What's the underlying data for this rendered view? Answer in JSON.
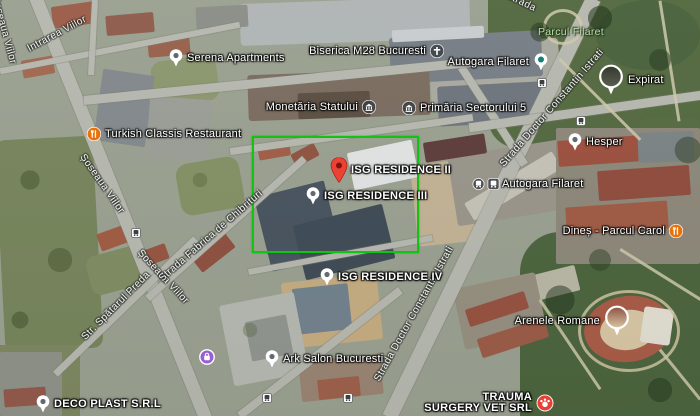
{
  "map": {
    "view": "satellite",
    "colors": {
      "selection_green": "#0fc512",
      "pin_red": "#EA4335",
      "restaurant_orange": "#E8710A",
      "shop_purple": "#9A5FD0",
      "transit_teal": "#12827A",
      "park_label_green": "#B6E0A2",
      "label_white": "#FFFFFF"
    },
    "selection_box": {
      "x": 252,
      "y": 136,
      "width": 167,
      "height": 117
    },
    "pois": [
      {
        "slug": "serena-apartments",
        "label": "Serena Apartments",
        "icon": "generic-poi-icon",
        "x": 176,
        "y": 58,
        "side": "right",
        "weight": "normal"
      },
      {
        "slug": "turkish-classis-restaurant",
        "label": "Turkish Classis Restaurant",
        "icon": "restaurant-icon",
        "x": 94,
        "y": 134,
        "side": "right",
        "weight": "normal"
      },
      {
        "slug": "biserica-m28-bucuresti",
        "label": "Biserica M28 Bucuresti",
        "icon": "church-icon",
        "x": 437,
        "y": 51,
        "side": "left",
        "weight": "normal"
      },
      {
        "slug": "monetaria-statului",
        "label": "Monetăria Statului",
        "icon": "government-icon",
        "x": 369,
        "y": 107,
        "side": "left",
        "weight": "normal"
      },
      {
        "slug": "primaria-sectorului-5",
        "label": "Primăria Sectorului 5",
        "icon": "government-icon",
        "x": 409,
        "y": 108,
        "side": "right",
        "weight": "normal"
      },
      {
        "slug": "autogara-filaret-pin",
        "label": "Autogara Filaret",
        "icon": "transit-pin-icon",
        "x": 541,
        "y": 62,
        "side": "left",
        "weight": "normal"
      },
      {
        "slug": "expirat",
        "label": "Expirat",
        "icon": "photo-pin-icon",
        "thumb": "dark",
        "x": 611,
        "y": 80,
        "side": "right",
        "weight": "normal"
      },
      {
        "slug": "hesper",
        "label": "Hesper",
        "icon": "generic-poi-icon",
        "x": 575,
        "y": 142,
        "side": "right",
        "weight": "normal"
      },
      {
        "slug": "autogara-filaret",
        "label": "Autogara Filaret",
        "icon": "bus-badges-icon",
        "x": 486,
        "y": 184,
        "side": "right",
        "weight": "normal"
      },
      {
        "slug": "isg-residence-ii",
        "label": "ISG RESIDENCE II",
        "icon": "red-pin-icon",
        "x": 339,
        "y": 170,
        "side": "right",
        "weight": "bold"
      },
      {
        "slug": "isg-residence-iii",
        "label": "ISG RESIDENCE III",
        "icon": "generic-poi-icon",
        "x": 313,
        "y": 196,
        "side": "right",
        "weight": "bold"
      },
      {
        "slug": "isg-residence-iv",
        "label": "ISG RESIDENCE IV",
        "icon": "generic-poi-icon",
        "x": 327,
        "y": 277,
        "side": "right",
        "weight": "bold"
      },
      {
        "slug": "ark-salon-bucuresti",
        "label": "Ark Salon Bucuresti",
        "icon": "generic-poi-icon",
        "x": 272,
        "y": 359,
        "side": "right",
        "weight": "normal"
      },
      {
        "slug": "deco-plast-srl",
        "label": "DECO PLAST S.R.L",
        "icon": "generic-poi-icon",
        "x": 43,
        "y": 404,
        "side": "right",
        "weight": "bold"
      },
      {
        "slug": "dines-parcul-carol",
        "label": "Dineș - Parcul Carol",
        "icon": "restaurant-icon",
        "x": 676,
        "y": 231,
        "side": "left",
        "weight": "normal"
      },
      {
        "slug": "arenele-romane",
        "label": "Arenele Romane",
        "icon": "photo-pin-icon",
        "thumb": "warm",
        "x": 617,
        "y": 321,
        "side": "left",
        "weight": "normal"
      },
      {
        "slug": "trauma-surgery-vet-srl",
        "lines": [
          "TRAUMA",
          "SURGERY VET SRL"
        ],
        "icon": "vet-icon",
        "x": 545,
        "y": 403,
        "side": "left",
        "weight": "bold"
      },
      {
        "slug": "shopping-place",
        "label": "",
        "icon": "shop-icon",
        "x": 207,
        "y": 357,
        "side": "right",
        "weight": "normal"
      }
    ],
    "park_labels": [
      {
        "label": "Parcul Filaret",
        "x": 571,
        "y": 32
      }
    ],
    "street_labels": [
      {
        "label": "Șoseaua Viilor",
        "x": 4,
        "y": 30,
        "rotation": 75
      },
      {
        "label": "Intrarea Viilor",
        "x": 57,
        "y": 34,
        "rotation": -28
      },
      {
        "label": "Șoseaua Viilor",
        "x": 102,
        "y": 184,
        "rotation": 55
      },
      {
        "label": "Șoseaua Viilor",
        "x": 163,
        "y": 277,
        "rotation": 47
      },
      {
        "label": "Str. Spătarul Preda",
        "x": 116,
        "y": 306,
        "rotation": -45
      },
      {
        "label": "Strada Fabrica de Chibrituri",
        "x": 211,
        "y": 236,
        "rotation": -41
      },
      {
        "label": "Strada Doctor Constantin Istrati",
        "x": 552,
        "y": 108,
        "rotation": -49
      },
      {
        "label": "Strada Doctor Constantin Istrati",
        "x": 414,
        "y": 314,
        "rotation": -61
      },
      {
        "label": "Strada",
        "x": 521,
        "y": 2,
        "rotation": 26
      }
    ],
    "transit_badges": [
      {
        "x": 136,
        "y": 233
      },
      {
        "x": 267,
        "y": 398
      },
      {
        "x": 348,
        "y": 398
      },
      {
        "x": 542,
        "y": 83
      },
      {
        "x": 581,
        "y": 121
      }
    ]
  }
}
